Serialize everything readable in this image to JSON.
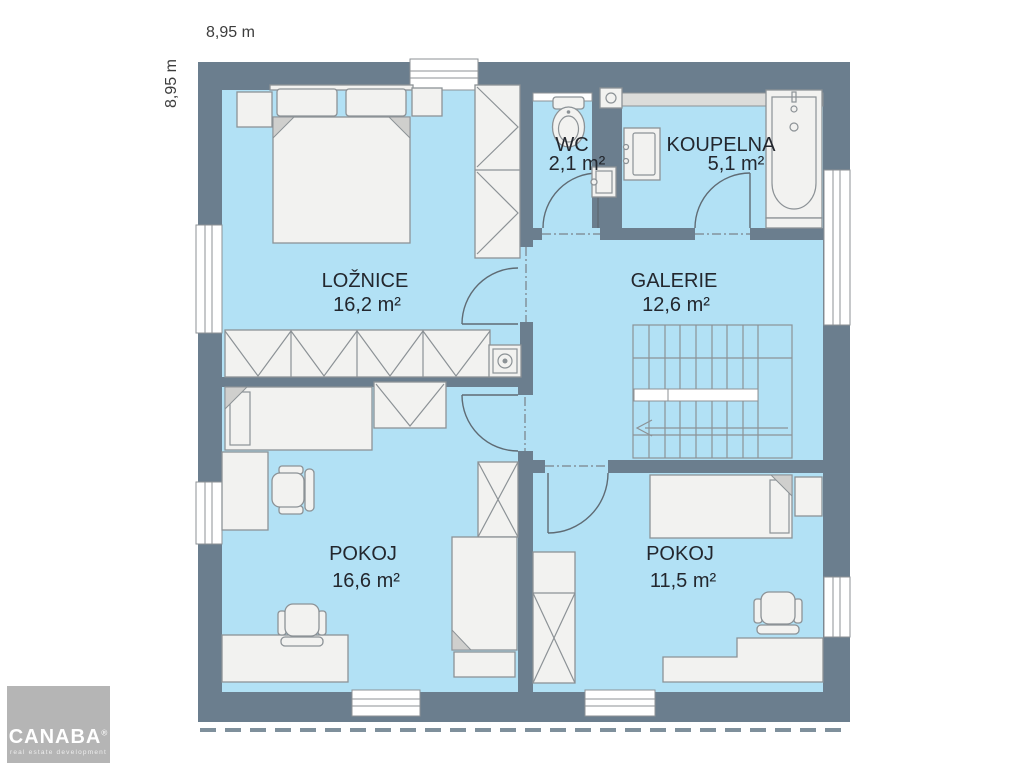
{
  "dimensions": {
    "width_label": "8,95 m",
    "height_label": "8,95 m"
  },
  "rooms": {
    "loznice": {
      "name": "LOŽNICE",
      "area": "16,2 m²"
    },
    "wc": {
      "name": "WC",
      "area": "2,1 m²"
    },
    "koupelna": {
      "name": "KOUPELNA",
      "area": "5,1 m²"
    },
    "galerie": {
      "name": "GALERIE",
      "area": "12,6 m²"
    },
    "pokoj_left": {
      "name": "POKOJ",
      "area": "16,6 m²"
    },
    "pokoj_right": {
      "name": "POKOJ",
      "area": "11,5 m²"
    }
  },
  "logo": {
    "brand": "CANABA",
    "registered": "®",
    "tagline": "real estate development"
  },
  "colors": {
    "wall": "#6b7e8e",
    "room_fill": "#b2e1f5",
    "furniture_fill": "#f2f2f0",
    "furniture_stroke": "#8c9296",
    "label_text": "#23272e",
    "logo_bg": "#b5b5b5",
    "door_stroke": "#5f6b74",
    "dash_color": "#8fa6b2"
  }
}
